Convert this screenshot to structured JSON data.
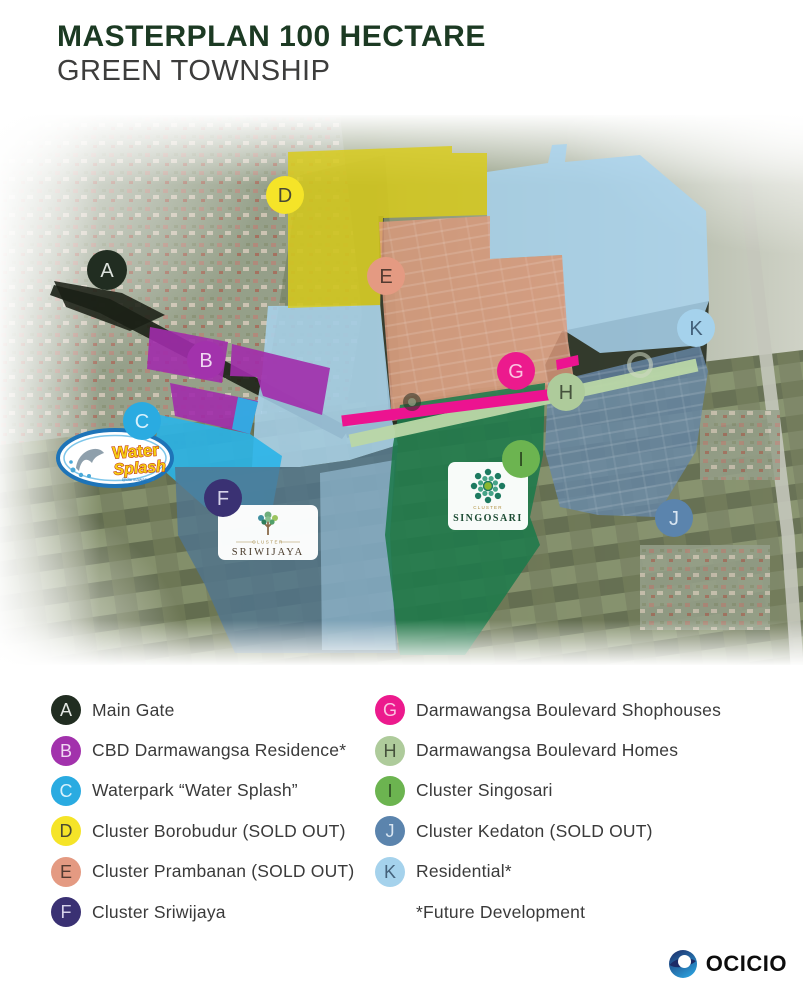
{
  "header": {
    "title": "MASTERPLAN 100 HECTARE",
    "subtitle": "GREEN TOWNSHIP",
    "title_color": "#1c3a23",
    "subtitle_color": "#3d3d3c"
  },
  "map": {
    "markers": [
      {
        "letter": "A",
        "color": "#212d21",
        "letter_color": "#dde2dd"
      },
      {
        "letter": "B",
        "color": "#a232ac",
        "letter_color": "#f0d9f2"
      },
      {
        "letter": "C",
        "color": "#2aabe1",
        "letter_color": "#d8f1fc"
      },
      {
        "letter": "D",
        "color": "#f5e428",
        "letter_color": "#4a4a33"
      },
      {
        "letter": "E",
        "color": "#e49a82",
        "letter_color": "#533b31"
      },
      {
        "letter": "F",
        "color": "#3a3173",
        "letter_color": "#d6d2ea"
      },
      {
        "letter": "G",
        "color": "#ec1a8d",
        "letter_color": "#fbc4e1"
      },
      {
        "letter": "H",
        "color": "#aecb9b",
        "letter_color": "#45523c"
      },
      {
        "letter": "I",
        "color": "#6cb450",
        "letter_color": "#2f4f23"
      },
      {
        "letter": "J",
        "color": "#5b84ad",
        "letter_color": "#d9e6f2"
      },
      {
        "letter": "K",
        "color": "#a5d2ec",
        "letter_color": "#44617a"
      }
    ],
    "regions": {
      "borobudur": "#d8cb1d",
      "prambanan": "#dd9a7d",
      "residential": "#a9d4ee",
      "cbd": "#a12cab",
      "waterpark": "#2ab4e8",
      "shophouses": "#ec1390",
      "homes": "#bad7a7",
      "singosari": "#1e7a4b",
      "kedaton": "#6787a8",
      "sriwijaya_area": "#50748e"
    },
    "logos": {
      "water_splash": {
        "line1": "Water",
        "line2": "Splash",
        "handle": "@darmawangsa"
      },
      "sriwijaya": {
        "cluster": "CLUSTER",
        "name": "SRIWIJAYA"
      },
      "singosari": {
        "cluster": "CLUSTER",
        "name": "SINGOSARI"
      }
    }
  },
  "legend": {
    "left": [
      {
        "letter": "A",
        "label": "Main Gate",
        "color": "#212d21",
        "letter_color": "#e3e7e3"
      },
      {
        "letter": "B",
        "label": "CBD Darmawangsa Residence*",
        "color": "#a232ac",
        "letter_color": "#f0d9f2"
      },
      {
        "letter": "C",
        "label": "Waterpark “Water Splash”",
        "color": "#2aabe1",
        "letter_color": "#d8f1fc"
      },
      {
        "letter": "D",
        "label": "Cluster Borobudur (SOLD OUT)",
        "color": "#f5e428",
        "letter_color": "#4a4a33"
      },
      {
        "letter": "E",
        "label": "Cluster Prambanan (SOLD OUT)",
        "color": "#e49a82",
        "letter_color": "#533b31"
      },
      {
        "letter": "F",
        "label": "Cluster Sriwijaya",
        "color": "#3a3173",
        "letter_color": "#d6d2ea"
      }
    ],
    "right": [
      {
        "letter": "G",
        "label": "Darmawangsa Boulevard Shophouses",
        "color": "#ec1a8d",
        "letter_color": "#fbc4e1"
      },
      {
        "letter": "H",
        "label": "Darmawangsa Boulevard Homes",
        "color": "#aecb9b",
        "letter_color": "#45523c"
      },
      {
        "letter": "I",
        "label": "Cluster Singosari",
        "color": "#6cb450",
        "letter_color": "#2f4f23"
      },
      {
        "letter": "J",
        "label": "Cluster Kedaton (SOLD OUT)",
        "color": "#5b84ad",
        "letter_color": "#d9e6f2"
      },
      {
        "letter": "K",
        "label": "Residential*",
        "color": "#a5d2ec",
        "letter_color": "#44617a"
      }
    ],
    "footnote": "*Future Development"
  },
  "footer": {
    "brand": "OCICIO"
  }
}
